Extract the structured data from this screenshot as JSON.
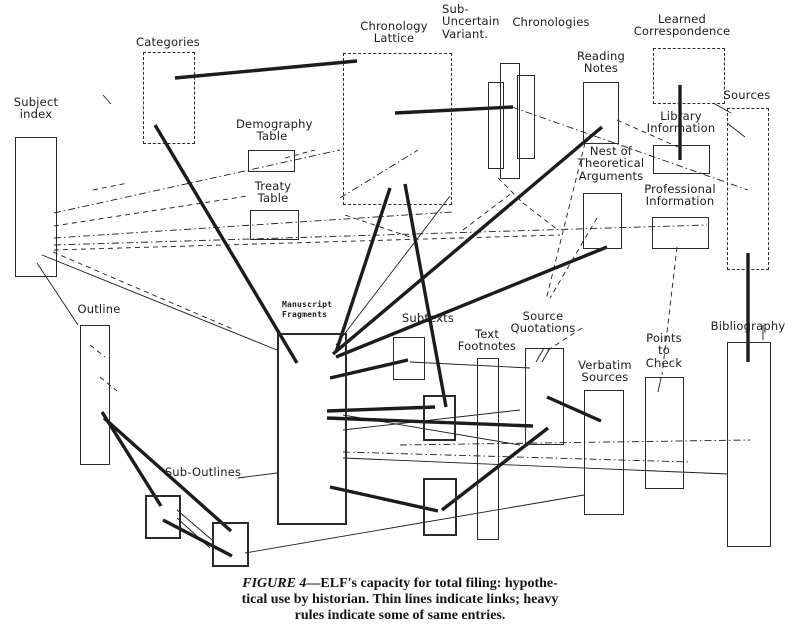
{
  "figure": {
    "ink": "#1c1c1c",
    "paper": "#ffffff",
    "caption": {
      "figure_label": "FIGURE 4",
      "line1_rest": "—ELF's capacity for total filing: hypothe-",
      "line2": "tical use by historian. Thin lines indicate links; heavy",
      "line3": "rules indicate some of same entries."
    }
  },
  "nodes": {
    "subject_index": {
      "label": "Subject\nindex"
    },
    "categories": {
      "label": "Categories"
    },
    "demography_table": {
      "label": "Demography\nTable"
    },
    "treaty_table": {
      "label": "Treaty\nTable"
    },
    "chronology_lattice": {
      "label": "Chronology\nLattice"
    },
    "sub_uncertain_variant": {
      "label": "Sub-\nUncertain\nVariant."
    },
    "chronologies": {
      "label": "Chronologies"
    },
    "reading_notes": {
      "label": "Reading\nNotes"
    },
    "nest_theoretical": {
      "label": "Nest of\nTheoretical\nArguments"
    },
    "learned_correspondence": {
      "label": "Learned\nCorrespondence"
    },
    "library_information": {
      "label": "Library\nInformation"
    },
    "professional_information": {
      "label": "Professional\nInformation"
    },
    "sources": {
      "label": "Sources"
    },
    "outline": {
      "label": "Outline"
    },
    "manuscript_fragments": {
      "label": "Manuscript\nFragments"
    },
    "subtexts": {
      "label": "Subtexts"
    },
    "text_footnotes": {
      "label": "Text\nFootnotes"
    },
    "source_quotations": {
      "label": "Source\nQuotations"
    },
    "verbatim_sources": {
      "label": "Verbatim\nSources"
    },
    "points_to_check": {
      "label": "Points\nto\nCheck"
    },
    "bibliography": {
      "label": "Bibliography"
    },
    "sub_outlines": {
      "label": "Sub-Outlines"
    }
  },
  "edges": [
    {
      "x1": 175,
      "y1": 78,
      "x2": 357,
      "y2": 61,
      "style": "heavy"
    },
    {
      "x1": 155,
      "y1": 125,
      "x2": 297,
      "y2": 363,
      "style": "heavy"
    },
    {
      "x1": 390,
      "y1": 188,
      "x2": 336,
      "y2": 352,
      "style": "heavy"
    },
    {
      "x1": 405,
      "y1": 184,
      "x2": 446,
      "y2": 407,
      "style": "heavy"
    },
    {
      "x1": 602,
      "y1": 127,
      "x2": 333,
      "y2": 354,
      "style": "heavy"
    },
    {
      "x1": 607,
      "y1": 247,
      "x2": 336,
      "y2": 357,
      "style": "heavy"
    },
    {
      "x1": 330,
      "y1": 378,
      "x2": 408,
      "y2": 360,
      "style": "heavy"
    },
    {
      "x1": 327,
      "y1": 411,
      "x2": 435,
      "y2": 407,
      "style": "heavy"
    },
    {
      "x1": 327,
      "y1": 418,
      "x2": 533,
      "y2": 426,
      "style": "heavy"
    },
    {
      "x1": 330,
      "y1": 487,
      "x2": 438,
      "y2": 511,
      "style": "heavy"
    },
    {
      "x1": 442,
      "y1": 510,
      "x2": 548,
      "y2": 428,
      "style": "heavy"
    },
    {
      "x1": 547,
      "y1": 397,
      "x2": 601,
      "y2": 421,
      "style": "heavy"
    },
    {
      "x1": 102,
      "y1": 412,
      "x2": 161,
      "y2": 506,
      "style": "heavy"
    },
    {
      "x1": 104,
      "y1": 418,
      "x2": 231,
      "y2": 531,
      "style": "heavy"
    },
    {
      "x1": 163,
      "y1": 520,
      "x2": 232,
      "y2": 556,
      "style": "heavy"
    },
    {
      "x1": 680,
      "y1": 85,
      "x2": 680,
      "y2": 160,
      "style": "heavy"
    },
    {
      "x1": 748,
      "y1": 253,
      "x2": 748,
      "y2": 362,
      "style": "heavy"
    },
    {
      "x1": 395,
      "y1": 113,
      "x2": 513,
      "y2": 107,
      "style": "heavy"
    },
    {
      "x1": 54,
      "y1": 213,
      "x2": 340,
      "y2": 150,
      "style": "dashdot"
    },
    {
      "x1": 54,
      "y1": 226,
      "x2": 248,
      "y2": 196,
      "style": "dash"
    },
    {
      "x1": 54,
      "y1": 238,
      "x2": 452,
      "y2": 212,
      "style": "dashdot"
    },
    {
      "x1": 54,
      "y1": 245,
      "x2": 707,
      "y2": 225,
      "style": "dashdot"
    },
    {
      "x1": 54,
      "y1": 250,
      "x2": 560,
      "y2": 235,
      "style": "dash"
    },
    {
      "x1": 42,
      "y1": 255,
      "x2": 277,
      "y2": 350,
      "style": "thin"
    },
    {
      "x1": 37,
      "y1": 263,
      "x2": 78,
      "y2": 325,
      "style": "thin"
    },
    {
      "x1": 53,
      "y1": 252,
      "x2": 235,
      "y2": 330,
      "style": "dash"
    },
    {
      "x1": 512,
      "y1": 107,
      "x2": 748,
      "y2": 190,
      "style": "dashdot"
    },
    {
      "x1": 617,
      "y1": 120,
      "x2": 678,
      "y2": 147,
      "style": "dash"
    },
    {
      "x1": 713,
      "y1": 103,
      "x2": 731,
      "y2": 113,
      "style": "thin"
    },
    {
      "x1": 597,
      "y1": 218,
      "x2": 550,
      "y2": 298,
      "style": "dash"
    },
    {
      "x1": 582,
      "y1": 328,
      "x2": 545,
      "y2": 352,
      "style": "dash"
    },
    {
      "x1": 336,
      "y1": 345,
      "x2": 450,
      "y2": 196,
      "style": "thin"
    },
    {
      "x1": 677,
      "y1": 247,
      "x2": 662,
      "y2": 375,
      "style": "dash"
    },
    {
      "x1": 661,
      "y1": 378,
      "x2": 658,
      "y2": 392,
      "style": "thin"
    },
    {
      "x1": 343,
      "y1": 458,
      "x2": 728,
      "y2": 474,
      "style": "thin"
    },
    {
      "x1": 343,
      "y1": 452,
      "x2": 690,
      "y2": 462,
      "style": "dashdot"
    },
    {
      "x1": 400,
      "y1": 445,
      "x2": 750,
      "y2": 440,
      "style": "dashdot"
    },
    {
      "x1": 343,
      "y1": 430,
      "x2": 520,
      "y2": 410,
      "style": "thin"
    },
    {
      "x1": 343,
      "y1": 415,
      "x2": 520,
      "y2": 445,
      "style": "thin"
    },
    {
      "x1": 410,
      "y1": 362,
      "x2": 530,
      "y2": 368,
      "style": "thin"
    },
    {
      "x1": 238,
      "y1": 478,
      "x2": 277,
      "y2": 473,
      "style": "thin"
    },
    {
      "x1": 245,
      "y1": 553,
      "x2": 584,
      "y2": 495,
      "style": "thin"
    },
    {
      "x1": 177,
      "y1": 510,
      "x2": 212,
      "y2": 540,
      "style": "thin"
    },
    {
      "x1": 177,
      "y1": 518,
      "x2": 210,
      "y2": 548,
      "style": "thin"
    },
    {
      "x1": 90,
      "y1": 345,
      "x2": 105,
      "y2": 357,
      "style": "dash"
    },
    {
      "x1": 100,
      "y1": 377,
      "x2": 117,
      "y2": 391,
      "style": "dash"
    },
    {
      "x1": 103,
      "y1": 95,
      "x2": 111,
      "y2": 104,
      "style": "thin"
    },
    {
      "x1": 93,
      "y1": 190,
      "x2": 128,
      "y2": 183,
      "style": "dash"
    },
    {
      "x1": 340,
      "y1": 198,
      "x2": 418,
      "y2": 150,
      "style": "dashdot"
    },
    {
      "x1": 345,
      "y1": 215,
      "x2": 413,
      "y2": 238,
      "style": "dash"
    },
    {
      "x1": 463,
      "y1": 230,
      "x2": 513,
      "y2": 192,
      "style": "dash"
    },
    {
      "x1": 498,
      "y1": 178,
      "x2": 523,
      "y2": 203,
      "style": "dash"
    },
    {
      "x1": 523,
      "y1": 203,
      "x2": 558,
      "y2": 230,
      "style": "dash"
    },
    {
      "x1": 285,
      "y1": 158,
      "x2": 315,
      "y2": 150,
      "style": "dash"
    },
    {
      "x1": 727,
      "y1": 123,
      "x2": 745,
      "y2": 137,
      "style": "thin"
    },
    {
      "x1": 585,
      "y1": 143,
      "x2": 546,
      "y2": 300,
      "style": "dash"
    },
    {
      "x1": 536,
      "y1": 362,
      "x2": 544,
      "y2": 348,
      "style": "thin"
    },
    {
      "x1": 542,
      "y1": 362,
      "x2": 550,
      "y2": 348,
      "style": "thin"
    },
    {
      "x1": 763,
      "y1": 325,
      "x2": 763,
      "y2": 340,
      "style": "thin"
    }
  ]
}
